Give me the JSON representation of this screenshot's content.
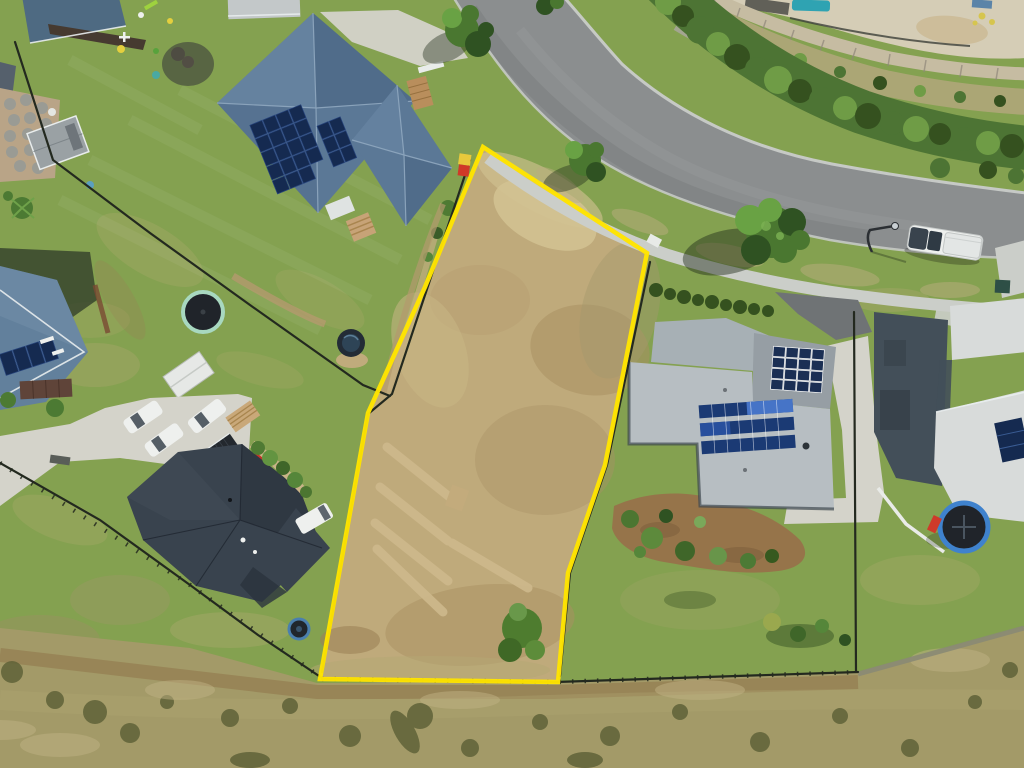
{
  "meta": {
    "description": "Aerial drone photograph of a vacant residential land parcel outlined in yellow, surrounded by suburban homes, a curved street, landscaped hedge with stone retaining wall and pool above the road, and a dry scrub paddock along the bottom",
    "image_width": 1024,
    "image_height": 768
  },
  "lot": {
    "boundary_points": "483,147 647,253 605,465 568,573 558,682 320,679 368,413 425,287",
    "outline_width": 4.5,
    "slash_strip_count": 5,
    "corner_marker_colors": [
      "#e8c93c",
      "#d03a28"
    ]
  },
  "palette": {
    "lawn": "#84a150",
    "lawnBright": "#7da24a",
    "lawnDry": "#a9a86b",
    "paddock": "#a39a68",
    "paddockDark": "#5f6238",
    "paddockBrown": "#8f7448",
    "lot": "#bfaa7b",
    "lotLight": "#d2c393",
    "lotBrown": "#a98f62",
    "lotStrip": "#cdb88b",
    "road": "#8b8e8f",
    "kerb": "#c9ccc9",
    "path": "#cbcec9",
    "concrete": "#d4d3ca",
    "asphaltDrive": "#6f7375",
    "hedge": "#4d7434",
    "hedgeLight": "#6f9c46",
    "hedgeDark": "#35511f",
    "tree": "#4a7730",
    "treeLight": "#69a244",
    "treeDark": "#2f5222",
    "scrubTan": "#b5a87e",
    "wallStone": "#c6bca2",
    "pool": "#2fa3b2",
    "roofA": "#5b7896",
    "roofALight": "#6e8aa7",
    "roofADark": "#46607e",
    "solar": "#152a50",
    "roofB": "#62809c",
    "roofC": "#39434e",
    "roofCDark": "#2b333d",
    "roofCLight": "#49545f",
    "garageC": "#23282e",
    "roofD": "#b7bec2",
    "roofDMid": "#a7b0b5",
    "roofDDark": "#969ea4",
    "roofE": "#d8dbda",
    "wallsDark": "#434f59",
    "fence": "#23291f",
    "white": "#eef0ee",
    "glass": "#3a444e",
    "yellow": "#ffe400",
    "markerRed": "#d03a28",
    "trampMint": "#a8d8c0",
    "trampMat": "#20242a",
    "trampBlue": "#3f82cd",
    "mulch": "#96744a",
    "dirt": "#bda377",
    "redItem": "#c03527",
    "shadow": "#1e2a18"
  },
  "scene": {
    "houses": [
      {
        "name": "top-left-house",
        "roof": "slate blue hip roof with rooftop solar array"
      },
      {
        "name": "left-edge-house",
        "roof": "blue-grey gable roof with solar panels"
      },
      {
        "name": "centre-left-house",
        "roof": "dark charcoal hip roof with metal garage"
      },
      {
        "name": "right-house",
        "roof": "light grey skillion roofs with two solar arrays"
      },
      {
        "name": "far-right-house",
        "roof": "white skillion roof with solar panel"
      }
    ],
    "vehicles": {
      "white_cars_on_parking_pad": 3,
      "white_van": 1,
      "white_ute_on_street": 1
    },
    "features": [
      "curved suburban street",
      "concrete footpath",
      "street light",
      "roadside trees",
      "hedge row and stone retaining wall",
      "swimming pool terrace",
      "mint-rim trampoline",
      "blue-rim trampoline",
      "round plunge pool",
      "dry slashed vacant lot",
      "scrubby paddock with dirt track"
    ]
  }
}
